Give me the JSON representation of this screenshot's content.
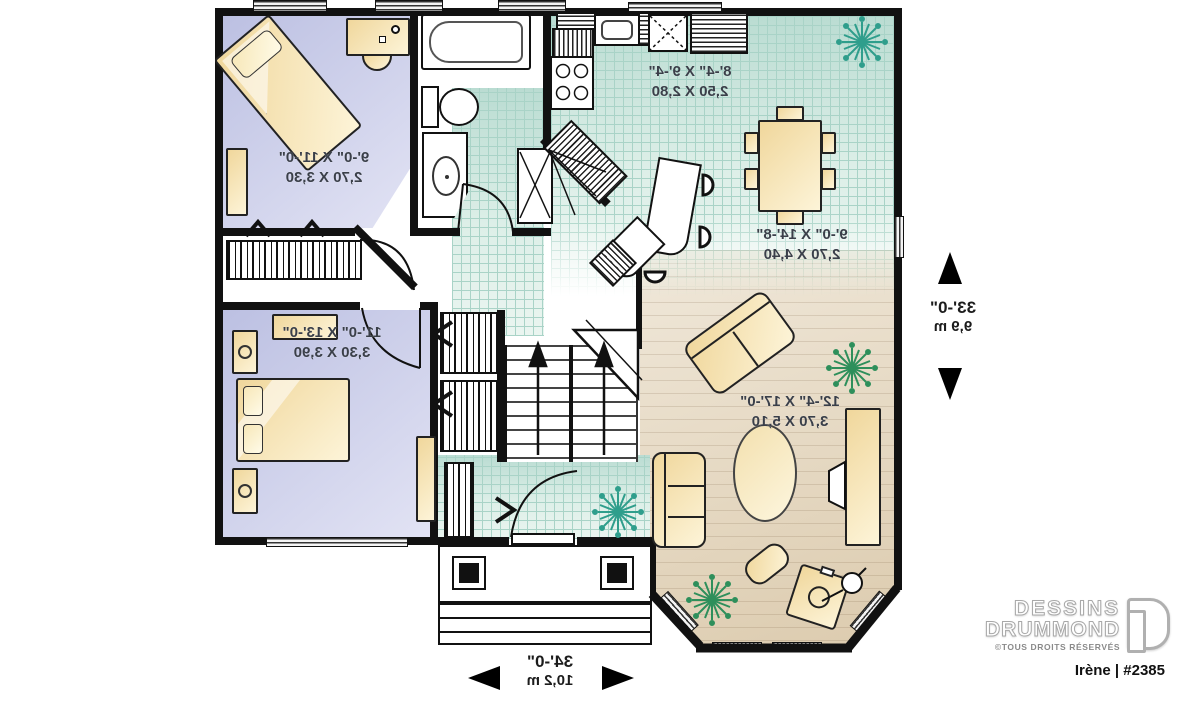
{
  "plan": {
    "rooms": [
      {
        "id": "bedroom-1",
        "imperial": "9'-0\" X 11'-0\"",
        "metric": "2,70 X 3,30"
      },
      {
        "id": "kitchen",
        "imperial": "8'-4\" X 9'-4\"",
        "metric": "2,50 X 2,80"
      },
      {
        "id": "dining",
        "imperial": "9'-0\" X 14'-8\"",
        "metric": "2,70 X 4,40"
      },
      {
        "id": "bedroom-2",
        "imperial": "11'-0\" X 13'-0\"",
        "metric": "3,30 X 3,90"
      },
      {
        "id": "living",
        "imperial": "12'-4\" X 17'-0\"",
        "metric": "3,70 X 5,10"
      }
    ],
    "dimensions": {
      "side": {
        "imperial": "33'-0\"",
        "metric": "9,9 m"
      },
      "bottom": {
        "imperial": "34'-0\"",
        "metric": "10,2 m"
      }
    }
  },
  "branding": {
    "name_line1": "DESSINS",
    "name_line2": "DRUMMOND",
    "rights": "©TOUS DROITS RÉSERVÉS",
    "plan_id": "Irène | #2385"
  },
  "colors": {
    "wall": "#111111",
    "floorBedroom": "#c9cde9",
    "tileBase": "#cfe8df",
    "tileLine": "#a9d3c7",
    "floorWood": "#e6dcc8",
    "furn": "#f0d79c",
    "furnLight": "#fdf4d8",
    "plantTeal": "#2f9e8c",
    "plantGreen": "#2e8f5b",
    "logoGray": "#a8a8a8",
    "labelGray": "#3a3f49"
  }
}
